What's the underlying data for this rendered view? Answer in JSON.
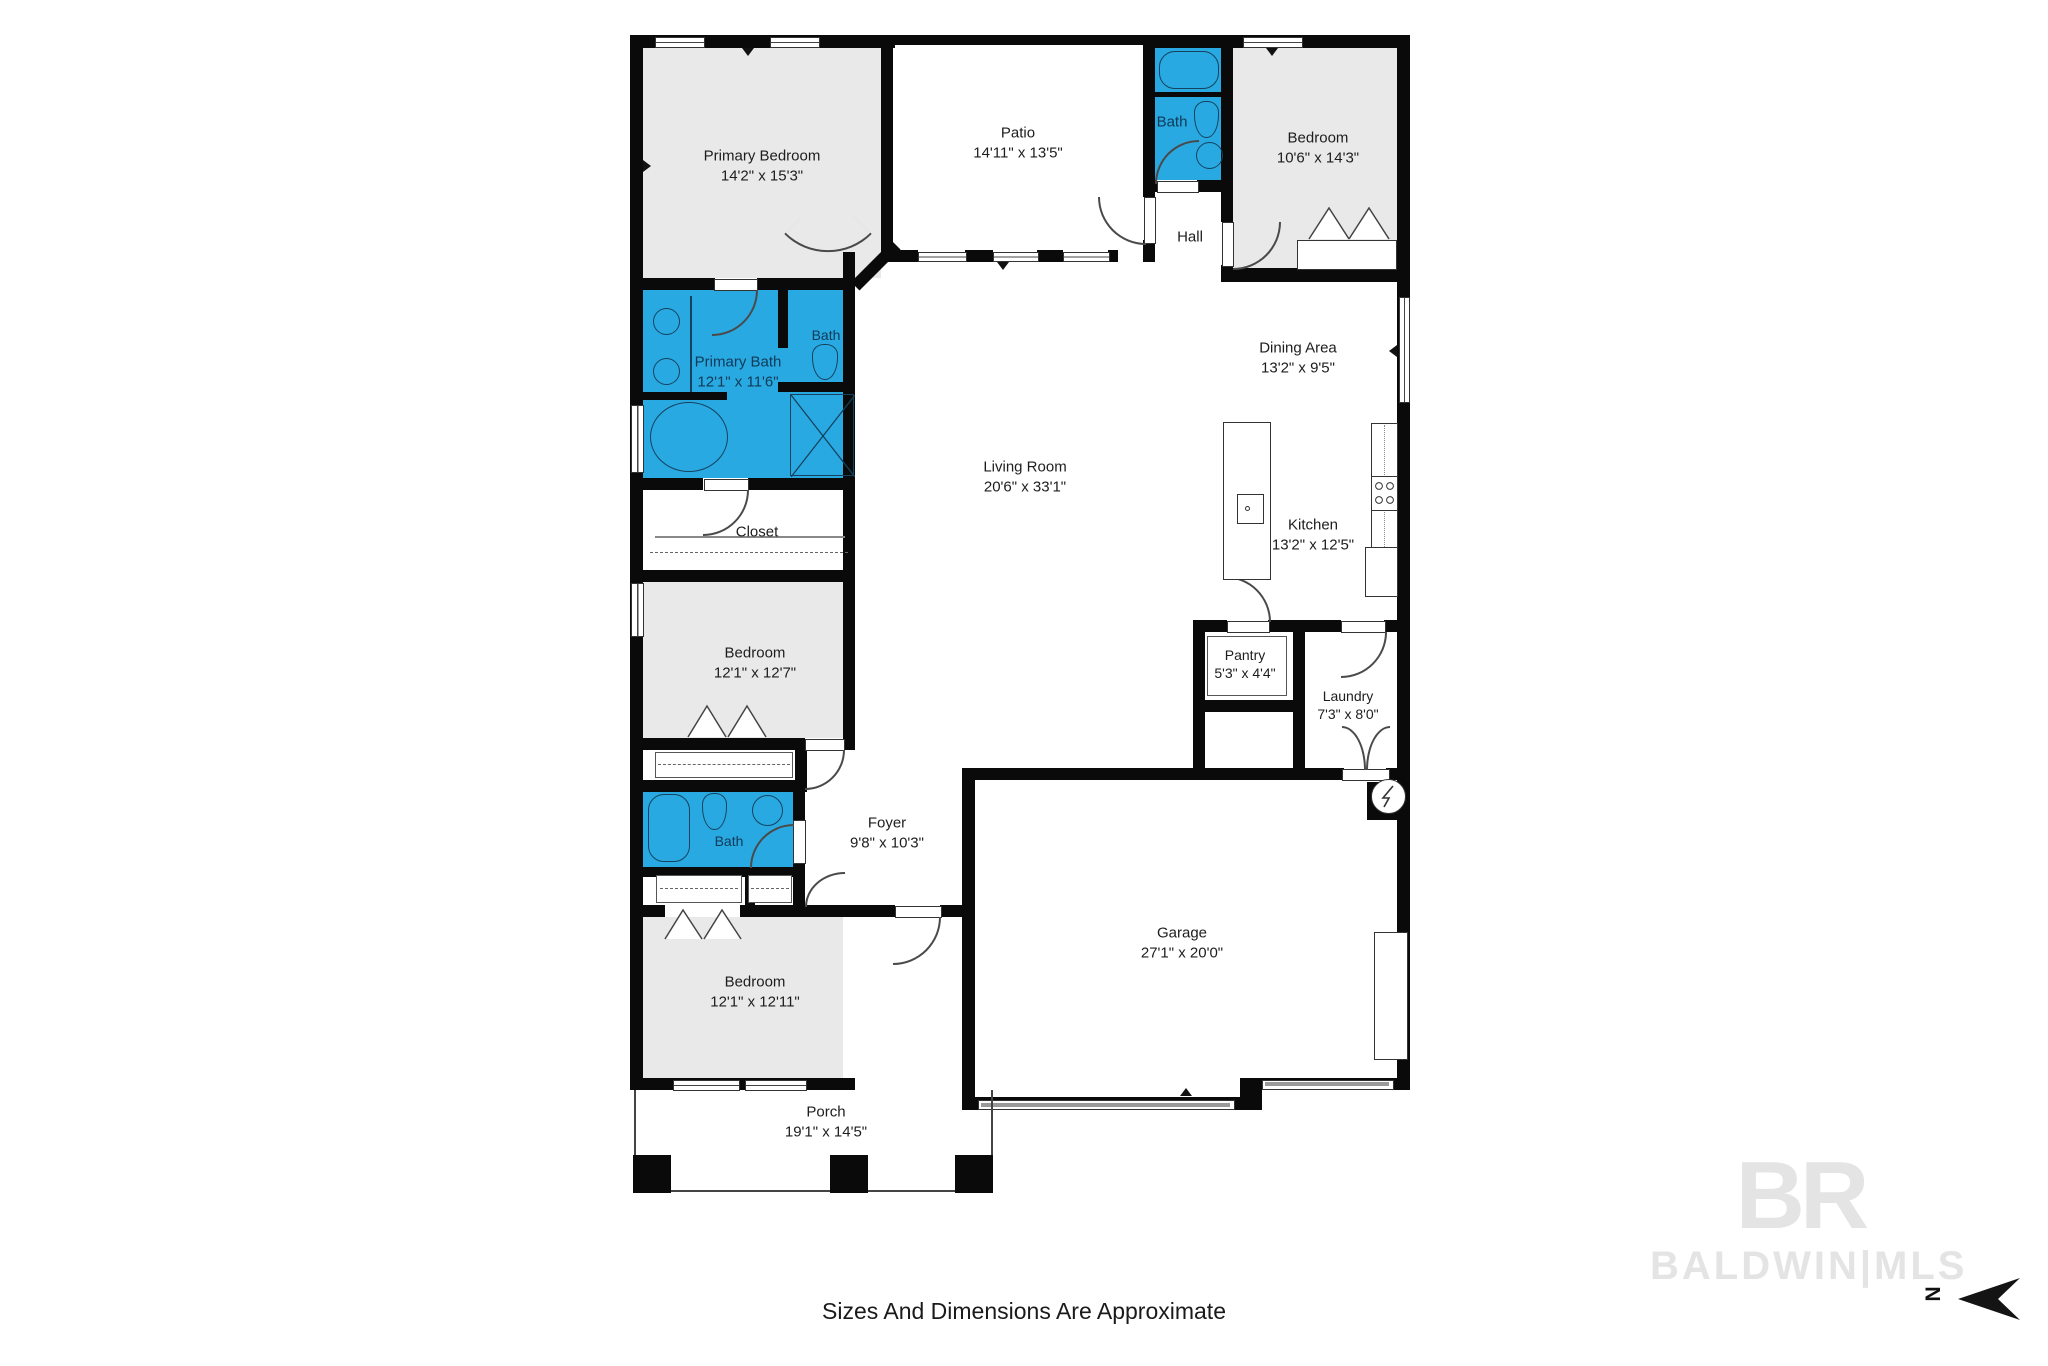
{
  "meta": {
    "footer": "Sizes And Dimensions Are Approximate",
    "watermark_monogram": "BR",
    "watermark_name": "BALDWIN|MLS",
    "north_label": "N",
    "colors": {
      "bath_fill": "#29a9e1",
      "room_fill": "#e9e9e9",
      "wall": "#0a0a0a",
      "watermark": "#e4e4e4",
      "garage_door": "#9a9a9a"
    },
    "icons": {
      "tub-icon": "bathtub outline",
      "toilet-icon": "toilet outline",
      "sink-icon": "round basin",
      "shower-icon": "square with X",
      "stove-icon": "4-burner cooktop",
      "water-heater-icon": "circle with bolt",
      "door-arc-icon": "door swing arc",
      "bifold-door-icon": "folding closet doors",
      "window-icon": "wall window",
      "north-arrow-icon": "arrow pointing left"
    }
  },
  "rooms": [
    {
      "id": "primary-bedroom",
      "name": "Primary Bedroom",
      "dims": "14'2\" x 15'3\""
    },
    {
      "id": "patio",
      "name": "Patio",
      "dims": "14'11\" x 13'5\""
    },
    {
      "id": "bath-top",
      "name": "Bath",
      "dims": ""
    },
    {
      "id": "bedroom-top",
      "name": "Bedroom",
      "dims": "10'6\" x 14'3\""
    },
    {
      "id": "hall",
      "name": "Hall",
      "dims": ""
    },
    {
      "id": "primary-bath",
      "name": "Primary Bath",
      "dims": "12'1\" x 11'6\""
    },
    {
      "id": "bath-wc",
      "name": "Bath",
      "dims": ""
    },
    {
      "id": "closet",
      "name": "Closet",
      "dims": ""
    },
    {
      "id": "dining-area",
      "name": "Dining Area",
      "dims": "13'2\" x 9'5\""
    },
    {
      "id": "living-room",
      "name": "Living Room",
      "dims": "20'6\" x 33'1\""
    },
    {
      "id": "kitchen",
      "name": "Kitchen",
      "dims": "13'2\" x 12'5\""
    },
    {
      "id": "bedroom-mid",
      "name": "Bedroom",
      "dims": "12'1\" x 12'7\""
    },
    {
      "id": "pantry",
      "name": "Pantry",
      "dims": "5'3\" x 4'4\""
    },
    {
      "id": "laundry",
      "name": "Laundry",
      "dims": "7'3\" x 8'0\""
    },
    {
      "id": "foyer",
      "name": "Foyer",
      "dims": "9'8\" x 10'3\""
    },
    {
      "id": "bath-bottom",
      "name": "Bath",
      "dims": ""
    },
    {
      "id": "bedroom-bottom",
      "name": "Bedroom",
      "dims": "12'1\" x 12'11\""
    },
    {
      "id": "garage",
      "name": "Garage",
      "dims": "27'1\" x 20'0\""
    },
    {
      "id": "porch",
      "name": "Porch",
      "dims": "19'1\" x 14'5\""
    }
  ]
}
